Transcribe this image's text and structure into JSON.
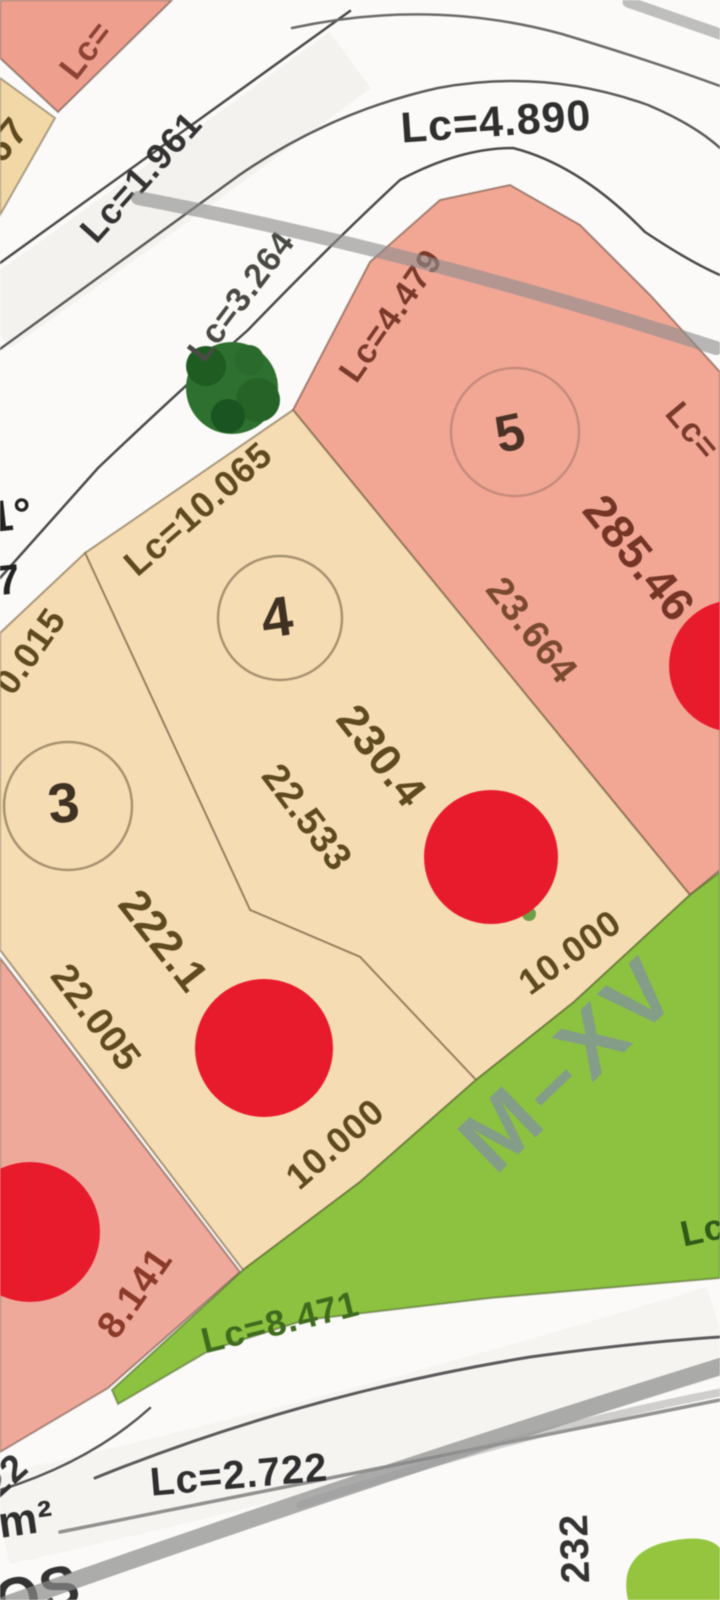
{
  "palette": {
    "lot_pink": "#f2a795",
    "lot_pink_sw": "#efa99b",
    "lot_pink_corner": "#ee9f8e",
    "lot_beige": "#f6dcb2",
    "lot_beige_corner": "#f2d8a6",
    "green_zone": "#8cc240",
    "green_blob": "#95c53f",
    "tree_green": "#2e7030",
    "marker_red": "#e81b2d",
    "road_line": "#4a4a4a",
    "streak_gray": "#8c8c8c",
    "label_olive": "#5f4a1f",
    "label_redbrown": "#8a3a28",
    "label_gray": "#333333",
    "label_green": "#3f6b1f",
    "mxv_gray": "#8291a0"
  },
  "lots": {
    "lot5": {
      "number": "5",
      "area": "285.46",
      "side": "23.664",
      "top_edge": "Lc=4.479",
      "right_edge_fragment": "Lc="
    },
    "lot4": {
      "number": "4",
      "area": "230.4",
      "side": "22.533",
      "top_edge": "Lc=10.065",
      "frontage": "10.000"
    },
    "lot3": {
      "number": "3",
      "area": "222.1",
      "side": "22.005",
      "top_edge_fragment": "0.015",
      "frontage": "10.000"
    },
    "lot2": {
      "frontage": "8.141"
    },
    "top_left_lot": {
      "edge_fragment": "Lc=",
      "number_fragment": "67"
    }
  },
  "roads": {
    "north_curve": "Lc=4.890",
    "northwest_road": "Lc=1.961",
    "tree_gap_curve": "Lc=3.264",
    "green_edge": "Lc=8.471",
    "south_road": "Lc=2.722",
    "green_right_fragment": "Lc"
  },
  "green_zone": {
    "block_label": "M–XV"
  },
  "edge_fragments": {
    "angle": "1°",
    "digit": "7",
    "number_22": "22",
    "unit_m2": "m²",
    "word_os": "OS",
    "vertical_232": "232"
  },
  "markers": {
    "red_count": 4
  }
}
